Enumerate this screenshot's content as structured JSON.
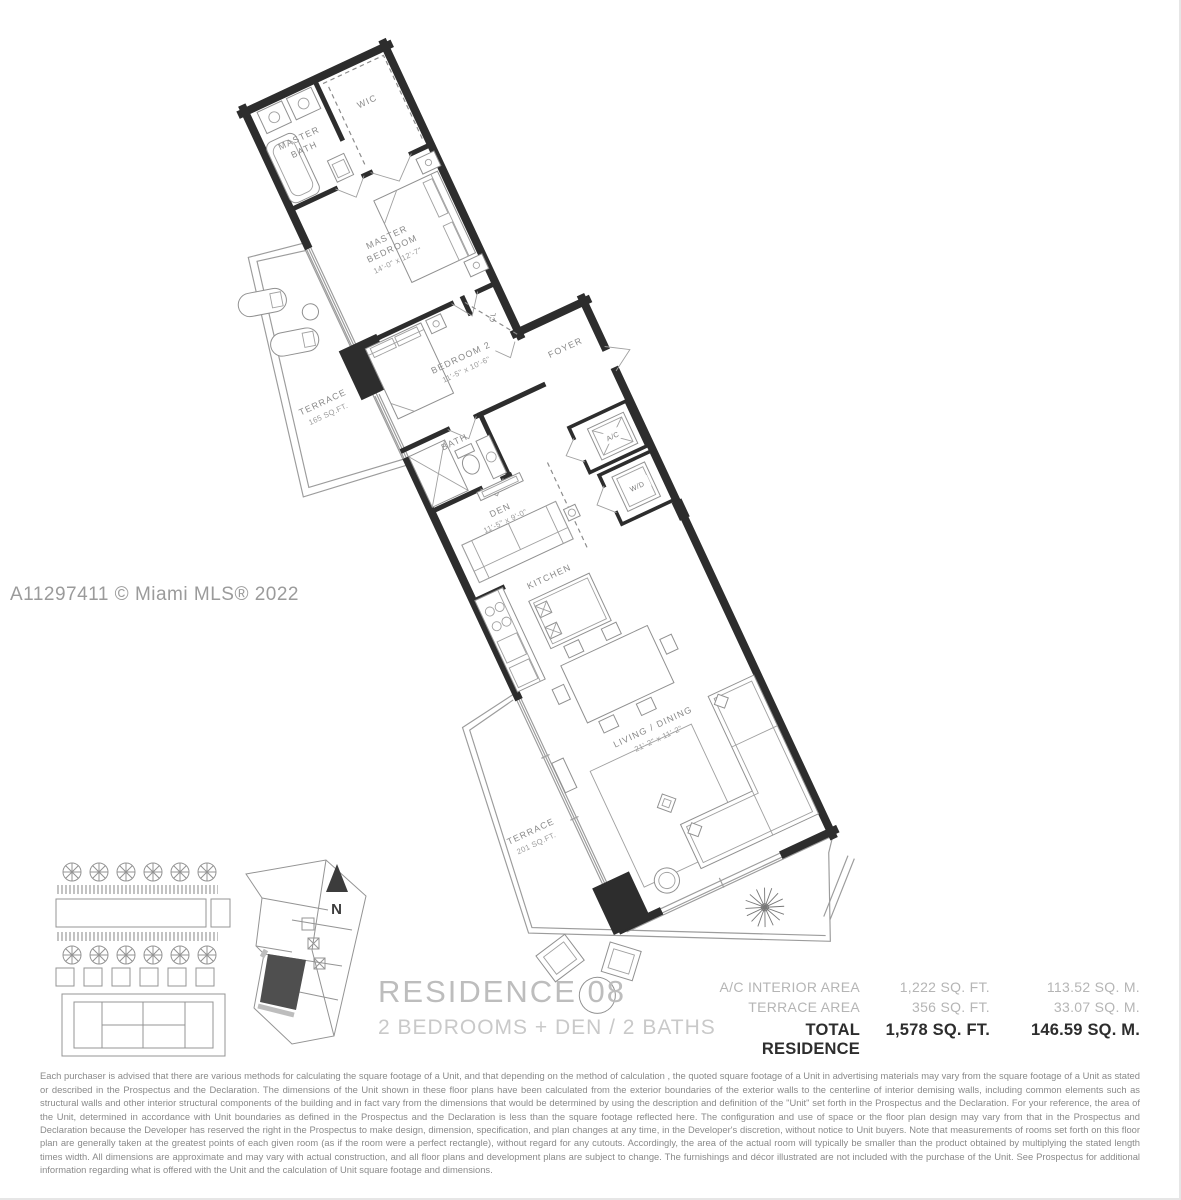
{
  "watermark": "A11297411 © Miami MLS® 2022",
  "title": {
    "name": "RESIDENCE 08",
    "subtitle": "2 BEDROOMS + DEN / 2 BATHS"
  },
  "north_label": "N",
  "rooms": {
    "master_bath": {
      "l1": "MASTER",
      "l2": "BATH"
    },
    "wic": "WIC",
    "master_bedroom": {
      "l1": "MASTER",
      "l2": "BEDROOM",
      "dim": "14'-0\" x 12'-7\""
    },
    "terrace_upper": {
      "l1": "TERRACE",
      "l2": "165 SQ.FT."
    },
    "bedroom2": {
      "l1": "BEDROOM 2",
      "dim": "11'-5\" x 10'-6\""
    },
    "closet": "CL",
    "bath2": "BATH",
    "foyer": "FOYER",
    "den": {
      "l1": "DEN",
      "dim": "11'-5\" x 9'-0\""
    },
    "ac": "A/C",
    "wd": "W/D",
    "kitchen": "KITCHEN",
    "living": {
      "l1": "LIVING / DINING",
      "dim": "21'-2\" x 11'-2\""
    },
    "terrace_lower": {
      "l1": "TERRACE",
      "l2": "201 SQ.FT."
    }
  },
  "area_table": {
    "rows": [
      {
        "label": "A/C INTERIOR AREA",
        "sqft": "1,222 SQ. FT.",
        "sqm": "113.52 SQ. M."
      },
      {
        "label": "TERRACE AREA",
        "sqft": "356 SQ. FT.",
        "sqm": "33.07 SQ. M."
      },
      {
        "label": "TOTAL RESIDENCE",
        "sqft": "1,578 SQ. FT.",
        "sqm": "146.59 SQ. M."
      }
    ]
  },
  "disclaimer": "Each purchaser is advised that there are various methods for calculating the square footage of a Unit, and that depending on the method of calculation , the quoted square footage of a Unit in advertising materials may vary from the square footage of a Unit as stated or described in the Prospectus and the Declaration.  The dimensions of the Unit shown in these floor plans have been calculated from the exterior boundaries of the exterior walls to the centerline of interior demising walls, including common elements such as structural walls and other interior structural components of the building and in fact vary from the dimensions that would be determined by using the description and definition of the \"Unit\" set forth in the Prospectus and the Declaration.  For your reference, the area of the Unit, determined in accordance with Unit boundaries as defined in the Prospectus and the Declaration is less than the square footage reflected here. The configuration and use of space or the floor plan design may vary from that in the Prospectus and Declaration because the Developer has reserved the right in the Prospectus to make design, dimension, specification, and plan changes at any time, in the Developer's discretion, without notice to Unit buyers. Note that measurements of rooms set forth on this floor plan are generally taken at the greatest points of each given room (as if the room were a perfect rectangle), without regard for any cutouts.  Accordingly, the area of the actual room will typically be smaller than the product obtained by multiplying the stated length times width.  All dimensions are approximate and may vary with actual construction, and all floor plans and development plans are subject to change.  The furnishings and décor illustrated are not included with the purchase of the Unit. See Prospectus for additional information regarding what is offered with the Unit and the calculation of Unit square footage and dimensions."
}
